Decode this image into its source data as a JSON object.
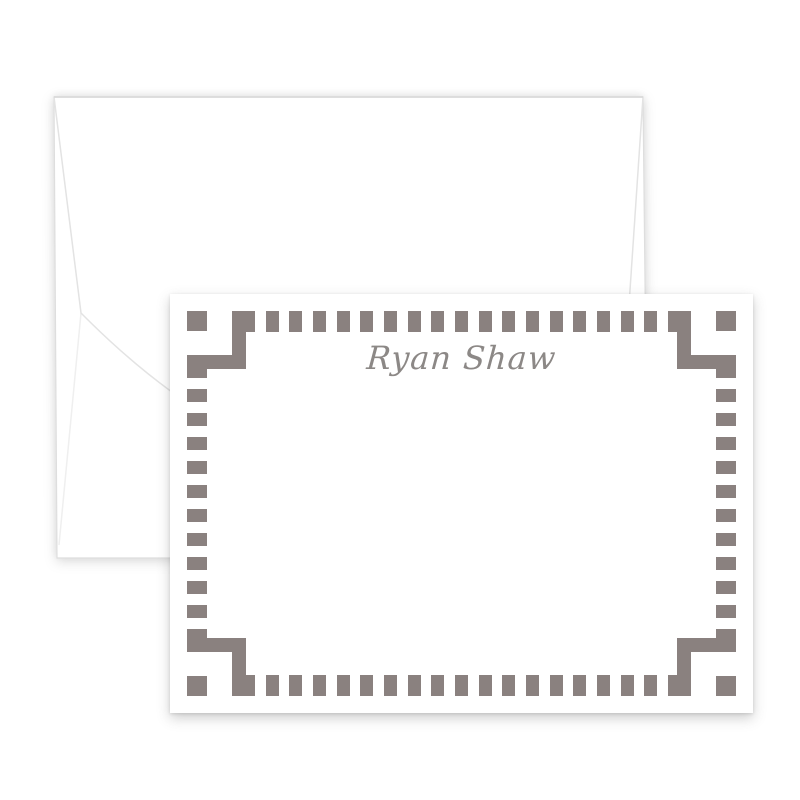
{
  "product_image": {
    "description": "White note card with square fret border over a white envelope",
    "name_text": "Ryan Shaw",
    "name_color": "#8c8886",
    "fret_color": "#8a817f",
    "card_bg": "#ffffff",
    "envelope_bg": "#ffffff",
    "envelope_line_color": "#e3e3e3",
    "border": {
      "top_dashes": 19,
      "bottom_dashes": 19,
      "left_dashes": 12,
      "right_dashes": 12
    }
  }
}
